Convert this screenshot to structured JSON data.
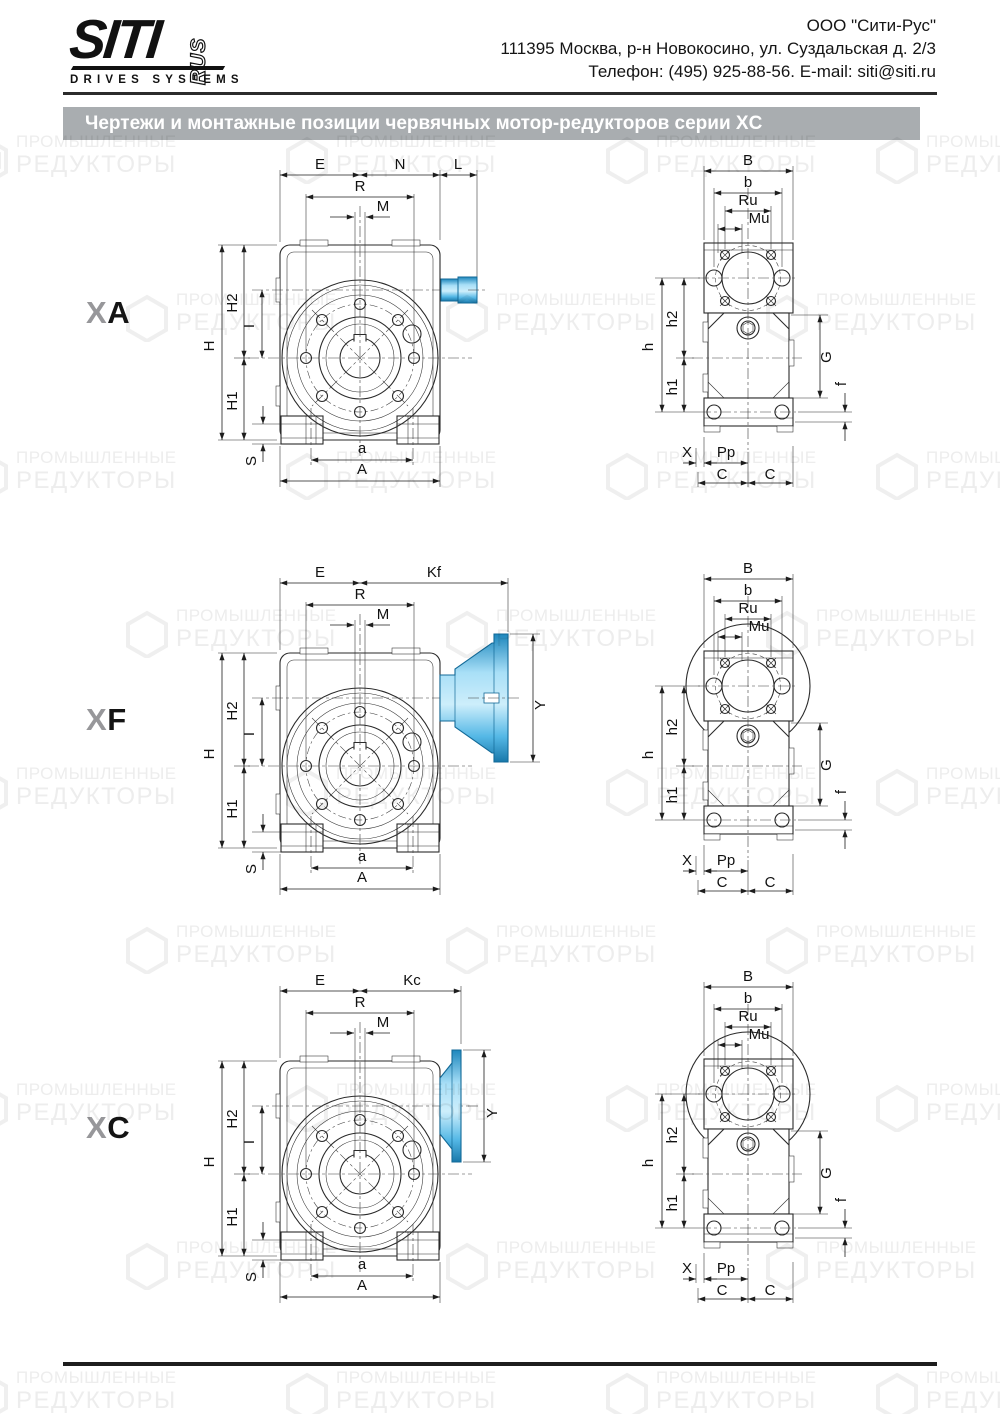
{
  "header": {
    "logo_siti": "SITI",
    "logo_rus": "RUS",
    "logo_subtitle": "DRIVES SYSTEMS",
    "company": "ООО \"Сити-Рус\"",
    "address": "111395 Москва, р-н Новокосино, ул. Суздальская д. 2/3",
    "phone_email": "Телефон: (495) 925-88-56. E-mail: siti@siti.ru"
  },
  "title_bar": {
    "text": "Чертежи и монтажные позиции червячных мотор-редукторов серии XC",
    "bg": "#a9adb0"
  },
  "watermark": {
    "line1": "ПРОМЫШЛЕННЫЕ",
    "line2": "РЕДУКТОРЫ"
  },
  "colors": {
    "accent_blue": "#2fa7dc",
    "accent_blue_dark": "#136a98",
    "line": "#2a2a2a",
    "title_bg": "#a9adb0"
  },
  "variants": [
    {
      "name": "XA",
      "label_gray": "X",
      "label_black": "A",
      "front": {
        "E": "E",
        "K": "N",
        "L": "L",
        "R": "R",
        "M": "M",
        "H": "H",
        "H2": "H2",
        "I": "I",
        "H1": "H1",
        "S": "S",
        "a": "a",
        "A": "A"
      },
      "side": {
        "B": "B",
        "b": "b",
        "Ru": "Ru",
        "Mu": "Mu",
        "h": "h",
        "h2": "h2",
        "h1": "h1",
        "G": "G",
        "f": "f",
        "X": "X",
        "Pp": "Pp",
        "C1": "C",
        "C2": "C"
      }
    },
    {
      "name": "XF",
      "label_gray": "X",
      "label_black": "F",
      "front": {
        "E": "E",
        "K": "Kf",
        "R": "R",
        "M": "M",
        "H": "H",
        "H2": "H2",
        "I": "I",
        "H1": "H1",
        "S": "S",
        "a": "a",
        "A": "A",
        "Y": "Y"
      },
      "side": {
        "B": "B",
        "b": "b",
        "Ru": "Ru",
        "Mu": "Mu",
        "h": "h",
        "h2": "h2",
        "h1": "h1",
        "G": "G",
        "f": "f",
        "X": "X",
        "Pp": "Pp",
        "C1": "C",
        "C2": "C"
      }
    },
    {
      "name": "XC",
      "label_gray": "X",
      "label_black": "C",
      "front": {
        "E": "E",
        "K": "Kc",
        "R": "R",
        "M": "M",
        "H": "H",
        "H2": "H2",
        "I": "I",
        "H1": "H1",
        "S": "S",
        "a": "a",
        "A": "A",
        "Y": "Y"
      },
      "side": {
        "B": "B",
        "b": "b",
        "Ru": "Ru",
        "Mu": "Mu",
        "h": "h",
        "h2": "h2",
        "h1": "h1",
        "G": "G",
        "f": "f",
        "X": "X",
        "Pp": "Pp",
        "C1": "C",
        "C2": "C"
      }
    }
  ]
}
